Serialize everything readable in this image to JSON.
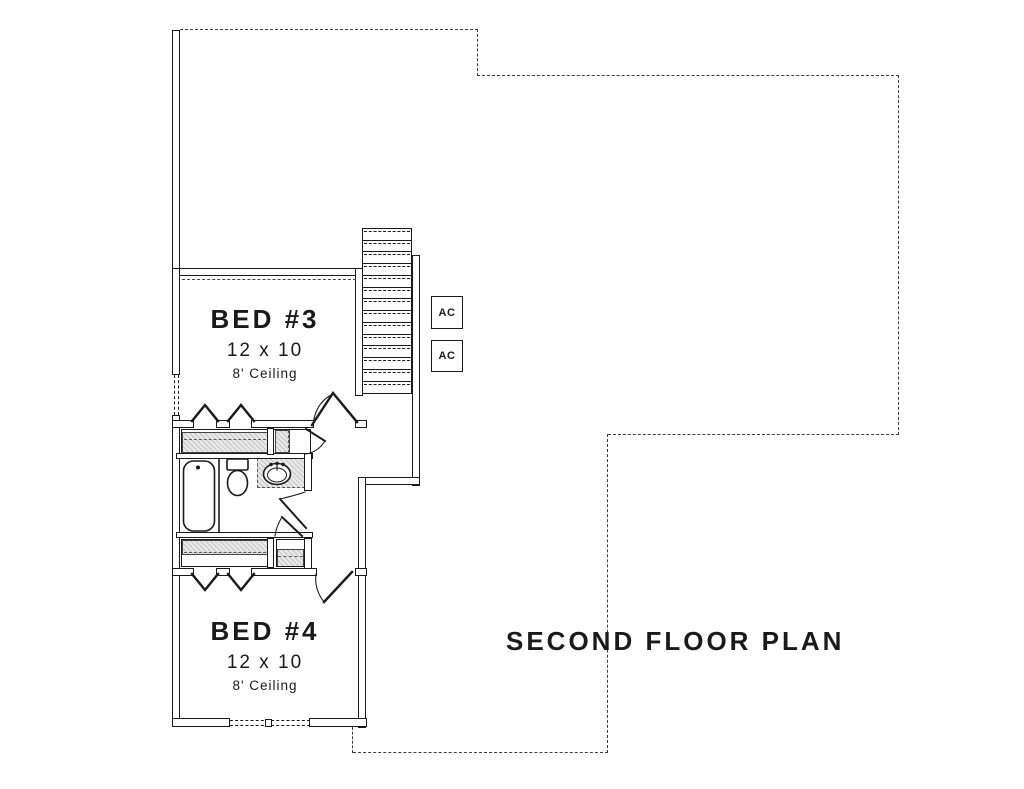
{
  "title": "SECOND FLOOR PLAN",
  "rooms": [
    {
      "name": "BED #3",
      "dimensions": "12 x 10",
      "ceiling": "8' Ceiling"
    },
    {
      "name": "BED #4",
      "dimensions": "12 x 10",
      "ceiling": "8' Ceiling"
    }
  ],
  "ac_units": [
    {
      "label": "AC"
    },
    {
      "label": "AC"
    }
  ],
  "colors": {
    "line": "#1a1a1a",
    "hatch_fill": "#e9e9e9"
  }
}
